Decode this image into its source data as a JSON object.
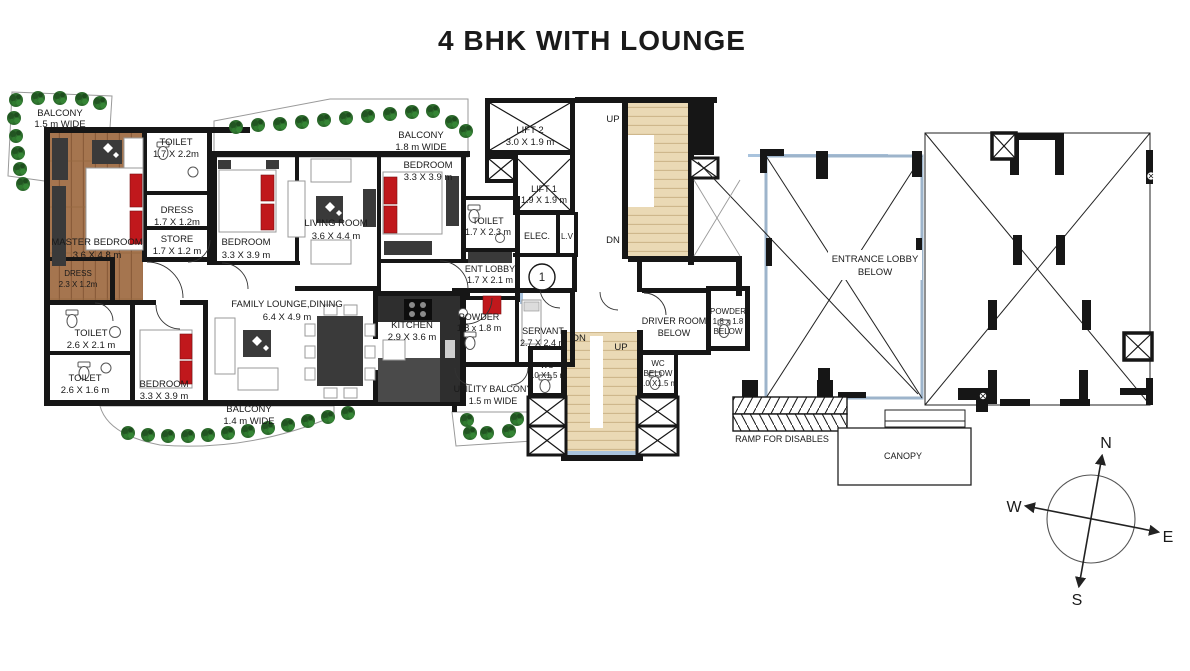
{
  "title": "4 BHK WITH LOUNGE",
  "unit_number": "1",
  "labels": {
    "balcony_tl": [
      "BALCONY",
      "1.5 m WIDE"
    ],
    "toilet_master": [
      "TOILET",
      "1.7 X 2.2m"
    ],
    "dress_1": [
      "DRESS",
      "1.7 X 1.2m"
    ],
    "store": [
      "STORE",
      "1.7 X 1.2 m"
    ],
    "master_bedroom": [
      "MASTER BEDROOM",
      "3.6 X 4.8 m"
    ],
    "dress_2": [
      "DRESS",
      "2.3 X 1.2m"
    ],
    "bedroom_2": [
      "BEDROOM",
      "3.3 X 3.9 m"
    ],
    "living_room": [
      "LIVING ROOM",
      "3.6 X 4.4 m"
    ],
    "balcony_top": [
      "BALCONY",
      "1.8 m WIDE"
    ],
    "bedroom_3": [
      "BEDROOM",
      "3.3 X 3.9 m"
    ],
    "toilet_3": [
      "TOILET",
      "1.7 X 2.3 m"
    ],
    "lift_2": [
      "LIFT 2",
      "3.0 X 1.9 m"
    ],
    "lift_1": [
      "LIFT 1",
      "1.9 X 1.9 m"
    ],
    "elec": [
      "ELEC."
    ],
    "lv": [
      "L.V"
    ],
    "ent_lobby": [
      "ENT LOBBY",
      "1.7 X 2.1 m"
    ],
    "toilet_1": [
      "TOILET",
      "2.6 X 2.1 m"
    ],
    "toilet_2": [
      "TOILET",
      "2.6 X 1.6 m"
    ],
    "bedroom_4": [
      "BEDROOM",
      "3.3 X 3.9 m"
    ],
    "family_lounge": [
      "FAMILY LOUNGE,DINING",
      "6.4 X 4.9 m"
    ],
    "kitchen": [
      "KITCHEN",
      "2.9 X 3.6 m"
    ],
    "balcony_bottom": [
      "BALCONY",
      "1.4 m WIDE"
    ],
    "powder": [
      "POWDER",
      "1.8 x 1.8 m"
    ],
    "servant": [
      "SERVANT",
      "2.7 X 2.4 m"
    ],
    "wc": [
      "WC",
      "1.0 X1.5 m"
    ],
    "utility_balcony": [
      "UTILITY BALCONY",
      "1.5 m WIDE"
    ],
    "wc_below": [
      "WC",
      "BELOW",
      "1.0 X1.5 m"
    ],
    "driver_room": [
      "DRIVER ROOM",
      "BELOW"
    ],
    "powder_below": [
      "POWDER",
      "1.8 x 1.8",
      "BELOW"
    ],
    "entrance_lobby": [
      "ENTRANCE LOBBY",
      "BELOW"
    ],
    "ramp": [
      "RAMP FOR DISABLES"
    ],
    "canopy": [
      "CANOPY"
    ]
  },
  "stairs": {
    "up": "UP",
    "down": "DN"
  },
  "compass": {
    "north": "N",
    "south": "S",
    "east": "E",
    "west": "W"
  },
  "colors": {
    "wall": "#161616",
    "wood": "#a5754f",
    "wood_dark": "#8a5c3a",
    "stair": "#ead9b5",
    "stair_tread": "#cbb287",
    "window": "#a9c3dd",
    "tree": "#2c6b2c",
    "accent_red": "#c0181c",
    "furniture_dark": "#3a3a3a",
    "outline_gray": "#9a9a9a",
    "lobby_outline": "#9db4cb"
  }
}
